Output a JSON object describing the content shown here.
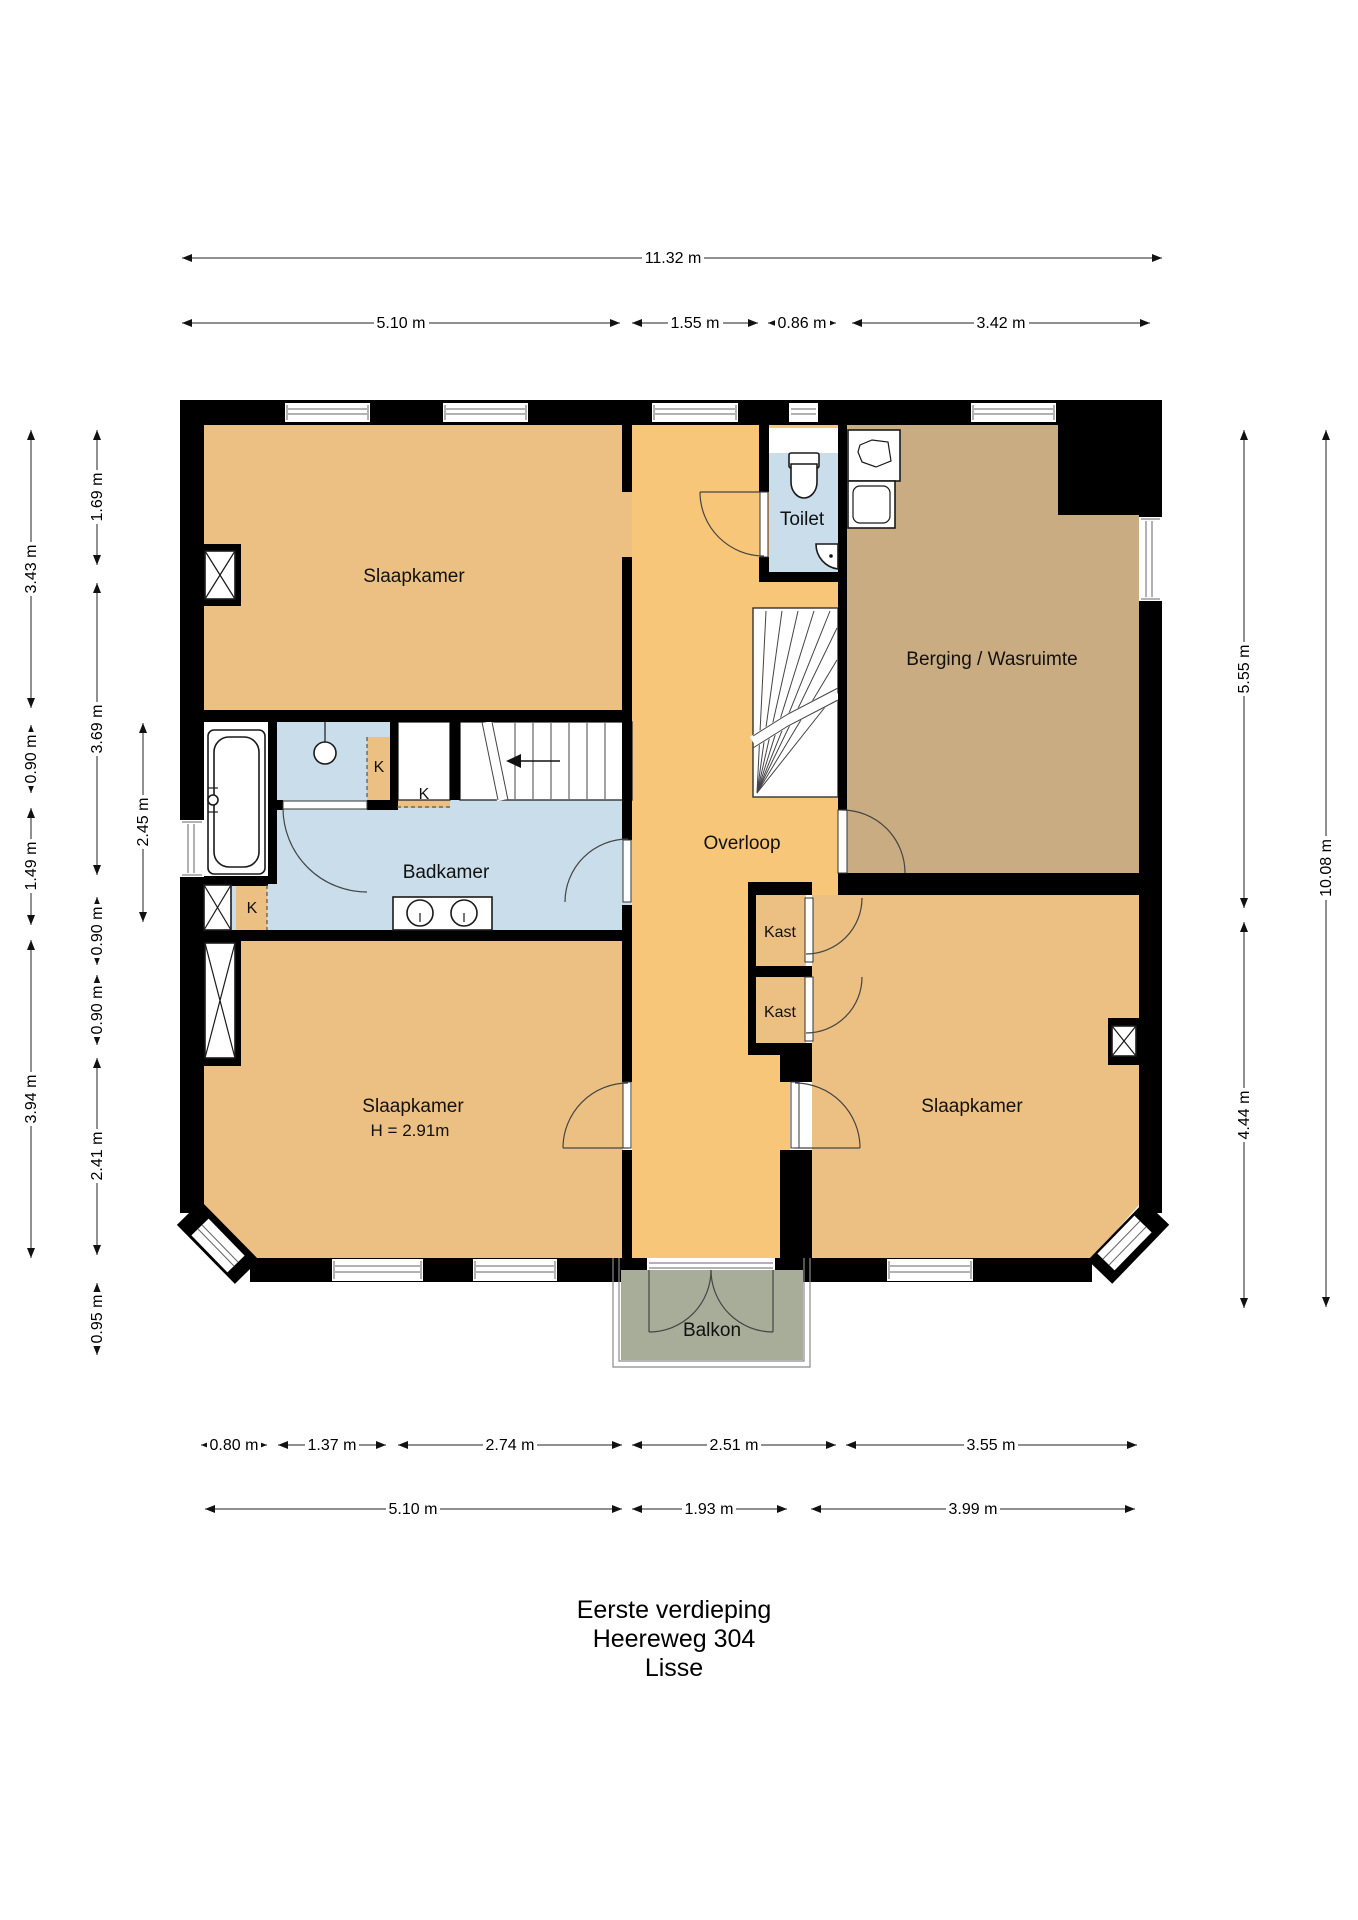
{
  "meta": {
    "title_lines": [
      "Eerste verdieping",
      "Heereweg 304",
      "Lisse"
    ]
  },
  "rooms": {
    "slaapkamer1": "Slaapkamer",
    "slaapkamer2": "Slaapkamer",
    "slaapkamer2_height": "H = 2.91m",
    "slaapkamer3": "Slaapkamer",
    "toilet": "Toilet",
    "berging": "Berging / Wasruimte",
    "overloop": "Overloop",
    "badkamer": "Badkamer",
    "kast1": "Kast",
    "kast2": "Kast",
    "balkon": "Balkon",
    "closet_k1": "K",
    "closet_k2": "K",
    "closet_k3": "K"
  },
  "dimensions": {
    "top_total": "11.32 m",
    "top_segments": [
      "5.10 m",
      "1.55 m",
      "0.86 m",
      "3.42 m"
    ],
    "bottom_upper": [
      "0.80 m",
      "1.37 m",
      "2.74 m",
      "2.51 m",
      "3.55 m"
    ],
    "bottom_lower": [
      "5.10 m",
      "1.93 m",
      "3.99 m"
    ],
    "left_outer": [
      "3.43 m",
      "0.90 m",
      "1.49 m",
      "3.94 m"
    ],
    "left_middle": [
      "1.69 m",
      "3.69 m",
      "0.90 m",
      "0.90 m",
      "2.41 m",
      "0.95 m"
    ],
    "left_inner": [
      "2.45 m"
    ],
    "right_inner": [
      "5.55 m",
      "4.44 m"
    ],
    "right_outer": [
      "10.08 m"
    ]
  },
  "colors": {
    "room_tan": "#ECC083",
    "hall_orange": "#F8C678",
    "storage_brown": "#C9AC82",
    "bath_blue": "#CADDEB",
    "balcony_green": "#A8AD9A",
    "wall": "#000000"
  }
}
